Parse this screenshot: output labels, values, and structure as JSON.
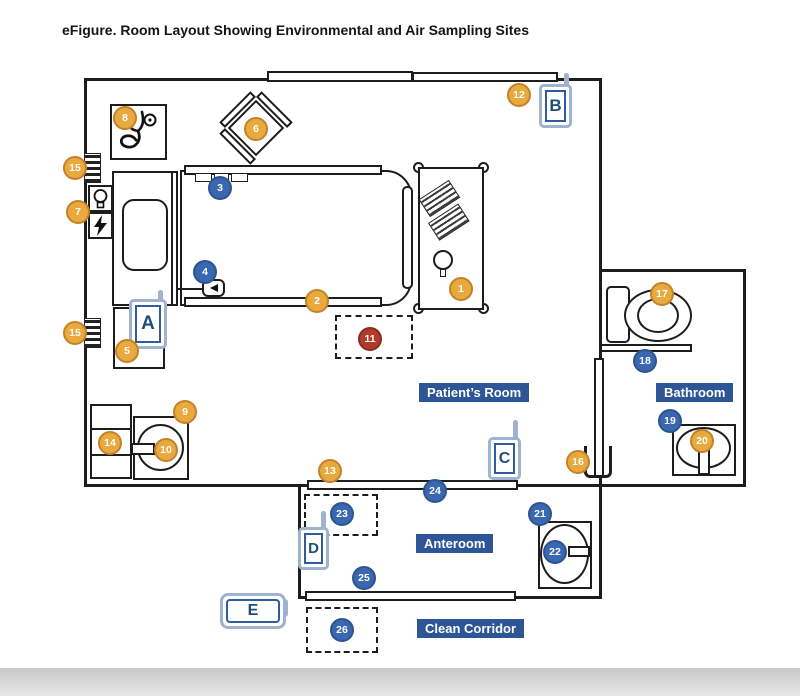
{
  "title": "eFigure. Room Layout Showing Environmental and Air Sampling Sites",
  "palette": {
    "surface_site_gold": "#E8A93E",
    "surface_site_gold_border": "#C2822A",
    "air_site_blue": "#3967B0",
    "air_site_blue_border": "#2E548F",
    "highlight_site_red": "#B13A2C",
    "room_label_bg": "#2E5697",
    "door_icon_border": "#9FB3D1",
    "door_letter_color": "#1F4E79",
    "wall_color": "#1d1d1d"
  },
  "room_labels": {
    "patients_room": "Patient’s Room",
    "bathroom": "Bathroom",
    "anteroom": "Anteroom",
    "clean_corridor": "Clean Corridor"
  },
  "door_labels": {
    "a": "A",
    "b": "B",
    "c": "C",
    "d": "D",
    "e": "E"
  },
  "markers": [
    {
      "label": "1",
      "type": "gold",
      "x": 461,
      "y": 289
    },
    {
      "label": "2",
      "type": "gold",
      "x": 317,
      "y": 301
    },
    {
      "label": "3",
      "type": "blue",
      "x": 220,
      "y": 188
    },
    {
      "label": "4",
      "type": "blue",
      "x": 205,
      "y": 272
    },
    {
      "label": "5",
      "type": "gold",
      "x": 127,
      "y": 351
    },
    {
      "label": "6",
      "type": "gold",
      "x": 256,
      "y": 129
    },
    {
      "label": "7",
      "type": "gold",
      "x": 78,
      "y": 212
    },
    {
      "label": "8",
      "type": "gold",
      "x": 125,
      "y": 118
    },
    {
      "label": "9",
      "type": "gold",
      "x": 185,
      "y": 412
    },
    {
      "label": "10",
      "type": "gold",
      "x": 166,
      "y": 450
    },
    {
      "label": "11",
      "type": "red",
      "x": 370,
      "y": 339
    },
    {
      "label": "12",
      "type": "gold",
      "x": 519,
      "y": 95
    },
    {
      "label": "13",
      "type": "gold",
      "x": 330,
      "y": 471
    },
    {
      "label": "14",
      "type": "gold",
      "x": 110,
      "y": 443
    },
    {
      "label": "15",
      "type": "gold",
      "x": 75,
      "y": 168
    },
    {
      "label": "15",
      "type": "gold",
      "x": 75,
      "y": 333
    },
    {
      "label": "16",
      "type": "gold",
      "x": 578,
      "y": 462
    },
    {
      "label": "17",
      "type": "gold",
      "x": 662,
      "y": 294
    },
    {
      "label": "18",
      "type": "blue",
      "x": 645,
      "y": 361
    },
    {
      "label": "19",
      "type": "blue",
      "x": 670,
      "y": 421
    },
    {
      "label": "20",
      "type": "gold",
      "x": 702,
      "y": 441
    },
    {
      "label": "21",
      "type": "blue",
      "x": 540,
      "y": 514
    },
    {
      "label": "22",
      "type": "blue",
      "x": 555,
      "y": 552
    },
    {
      "label": "23",
      "type": "blue",
      "x": 342,
      "y": 514
    },
    {
      "label": "24",
      "type": "blue",
      "x": 435,
      "y": 491
    },
    {
      "label": "25",
      "type": "blue",
      "x": 364,
      "y": 578
    },
    {
      "label": "26",
      "type": "blue",
      "x": 342,
      "y": 630
    }
  ]
}
